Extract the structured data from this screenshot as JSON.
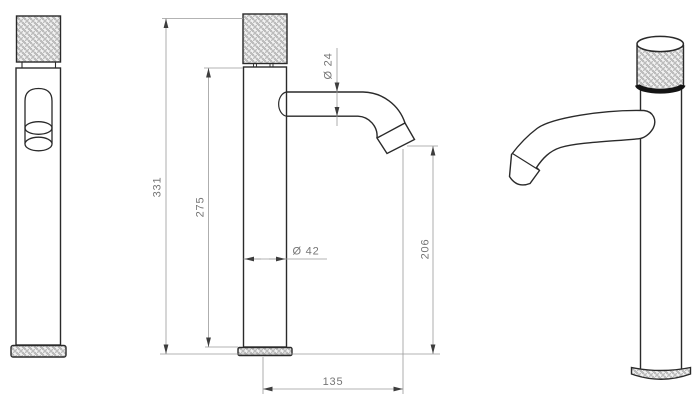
{
  "drawing": {
    "dimensions": {
      "total_height": "331",
      "body_height": "275",
      "spout_diameter": "Ø 24",
      "body_diameter": "Ø 42",
      "spout_outlet_height": "206",
      "spout_reach": "135"
    },
    "colors": {
      "object_line": "#2a2a2a",
      "dimension_line": "#9a9a9a",
      "dimension_text": "#757575",
      "arrow": "#3d3d3d",
      "knurl_background": "#f3f3f3",
      "knurl_line": "#9a9a9a",
      "background": "#ffffff"
    }
  }
}
